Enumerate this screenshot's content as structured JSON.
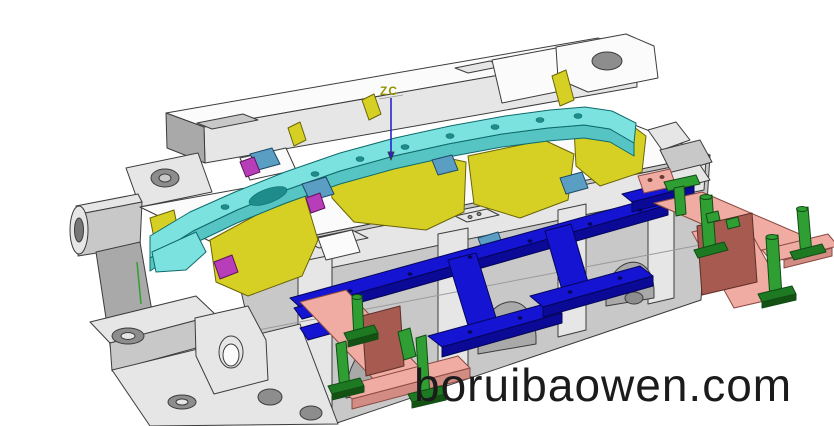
{
  "image_type": "3D CAD rendering",
  "subject": "Automotive injection mold tool assembly, isometric view",
  "watermark": {
    "text": "boruibaowen.com"
  },
  "axis_indicator": {
    "label": "ZC"
  },
  "palette": {
    "base_gray": "#c8c8c8",
    "product_cyan": "#7ce2e0",
    "insert_yellow": "#d7d024",
    "ejector_blue": "#1414d2",
    "plate_pink": "#f0aba3",
    "wall_red": "#a65a50",
    "pin_green": "#2f9e33",
    "wedge_magenta": "#b83db8",
    "block_steelblue": "#5a9ec4",
    "axis_blue": "#2525cc",
    "axis_label_olive": "#949400",
    "watermark_color": "#1b1b1b"
  },
  "components": [
    {
      "name": "mold-base",
      "color": "#c8c8c8",
      "description": "Gray mold base plates with guide bosses, rails and arched ribs"
    },
    {
      "name": "molded-part",
      "color": "#7ce2e0",
      "description": "Cyan curved bumper-trim product lying across the core"
    },
    {
      "name": "cavity-inserts",
      "color": "#d7d024",
      "description": "Yellow core and cavity insert blocks around the part"
    },
    {
      "name": "ejector-runner-bars",
      "color": "#1414d2",
      "description": "Blue T-shaped ejector runner bars on the parting face"
    },
    {
      "name": "slide-plates",
      "color": "#f0aba3",
      "description": "Pink slide base plates extending to the right and front"
    },
    {
      "name": "support-walls",
      "color": "#a65a50",
      "description": "Dark red support walls standing on the pink plates"
    },
    {
      "name": "guide-pins",
      "color": "#2f9e33",
      "description": "Green guide pins and stop posts on the slide plates"
    },
    {
      "name": "wedge-blocks",
      "color": "#b83db8",
      "description": "Magenta wedge lock blocks"
    },
    {
      "name": "slider-blocks",
      "color": "#5a9ec4",
      "description": "Steel-blue slider blocks"
    }
  ]
}
